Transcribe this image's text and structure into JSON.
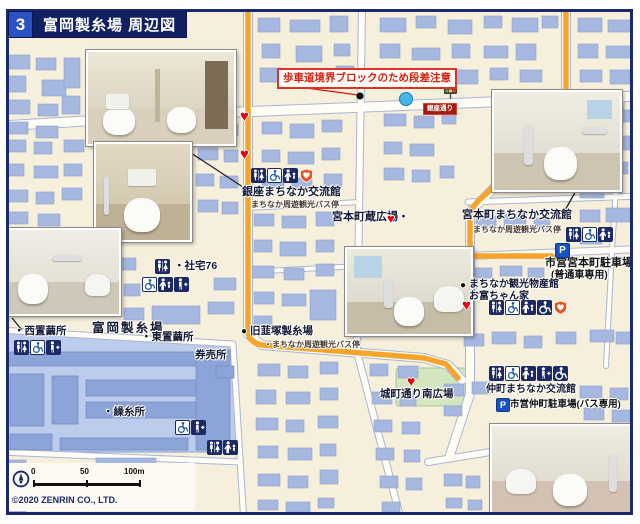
{
  "header": {
    "index": "3",
    "title": "富岡製糸場 周辺図"
  },
  "warning": {
    "text": "歩車道境界ブロックのため段差注意"
  },
  "signal": {
    "name": "銀座通り"
  },
  "pois": {
    "ginza_kan": {
      "name": "銀座まちなか交流館",
      "bus": "まちなか周遊観光バス停",
      "icons": [
        "toilet",
        "wheelchair",
        "baby-seat",
        "aed"
      ]
    },
    "miyamoto_kura": {
      "name": "宮本町蔵広場・"
    },
    "miyamoto_kan": {
      "name": "宮本町まちなか交流館",
      "bus": "まちなか周遊観光バス停",
      "icons": [
        "toilet",
        "wheelchair",
        "baby-seat"
      ]
    },
    "miyamoto_parking": {
      "name": "市営宮本町駐車場",
      "sub": "(普通車専用)"
    },
    "bussankan": {
      "name": "まちなか観光物産館",
      "name2": "お富ちゃん家",
      "icons": [
        "toilet",
        "wheelchair",
        "baby-seat",
        "wheelchair-assist",
        "aed"
      ]
    },
    "shataku": {
      "name": "・社宅76",
      "icons": [
        "toilet",
        "wheelchair",
        "baby-seat",
        "ostomate"
      ]
    },
    "nishi": {
      "name": "・西置繭所",
      "icons": [
        "toilet",
        "wheelchair",
        "ostomate"
      ]
    },
    "mill": {
      "name": "富岡製糸場"
    },
    "higashi": {
      "name": "・東置繭所"
    },
    "ticket": {
      "name": "券売所"
    },
    "nirazuka": {
      "name": "旧韮塚製糸場",
      "bus": "・まちなか周遊観光バス停"
    },
    "kuri": {
      "name": "・繰糸所",
      "icons": [
        "wheelchair",
        "ostomate",
        "toilet",
        "baby-seat"
      ]
    },
    "shiromachi": {
      "name": "城町通り南広場"
    },
    "nakamachi_kan": {
      "name": "仲町まちなか交流館",
      "icons": [
        "toilet",
        "wheelchair",
        "baby-seat",
        "ostomate",
        "wheelchair-assist"
      ]
    },
    "nakamachi_parking": {
      "name": "市営仲町駐車場(バス専用)"
    }
  },
  "symbols": {
    "heart": "♥",
    "bullet": "●",
    "parking": "P"
  },
  "scalebar": {
    "t0": "0",
    "t50": "50",
    "t100": "100m"
  },
  "copyright": {
    "text": "©2020 ZENRIN CO., LTD."
  },
  "photos": [
    {
      "id": "photo-1",
      "desc": "restroom interior with stalls"
    },
    {
      "id": "photo-2",
      "desc": "toilet room"
    },
    {
      "id": "photo-3",
      "desc": "accessible toilet room"
    },
    {
      "id": "photo-4",
      "desc": "accessible toilet with washbasin"
    },
    {
      "id": "photo-5",
      "desc": "accessible toilet with grab bars"
    },
    {
      "id": "photo-6",
      "desc": "toilet room"
    }
  ],
  "colors": {
    "route": "#f6a42c",
    "building": "#a7b8e0",
    "heart": "#e60012",
    "frame": "#1a2a6c",
    "map_bg": "#f6efdb"
  }
}
